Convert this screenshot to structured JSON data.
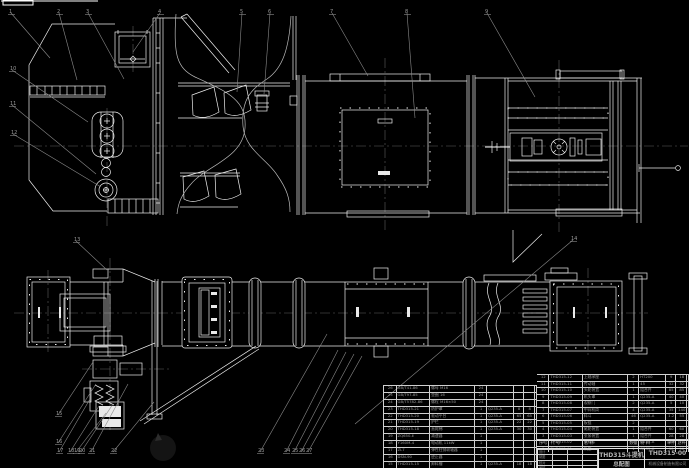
{
  "colors": {
    "background": "#000000",
    "line": "#ededed",
    "leader": "#8a8a8a",
    "bom_text": "#9a9a9a"
  },
  "title_block": {
    "product": "THD315斗提机",
    "sheet": "总配图",
    "drawing_no": "THD315-00",
    "company": "机械设备制造有限公司",
    "sign_labels": [
      "设计",
      "制图",
      "校对",
      "审核"
    ]
  },
  "bom": {
    "headers": {
      "seq": "序号",
      "code": "代  号",
      "name": "名  称",
      "qty": "数量",
      "mat": "材  料",
      "w1": "单件",
      "w2": "总计",
      "note": "备注"
    },
    "left_rows": [
      {
        "seq": "26",
        "code": "GB/T41-86",
        "name": "螺母 M16",
        "qty": "24",
        "mat": "",
        "w1": "",
        "w2": "",
        "note": ""
      },
      {
        "seq": "25",
        "code": "GB/T97-85",
        "name": "垫圈 16",
        "qty": "24",
        "mat": "",
        "w1": "",
        "w2": "",
        "note": ""
      },
      {
        "seq": "24",
        "code": "GB/T5782-86",
        "name": "螺栓 M16×50",
        "qty": "24",
        "mat": "",
        "w1": "",
        "w2": "",
        "note": ""
      },
      {
        "seq": "23",
        "code": "THD315-21",
        "name": "防护罩",
        "qty": "1",
        "mat": "Q235-A",
        "w1": "8",
        "w2": "8",
        "note": ""
      },
      {
        "seq": "22",
        "code": "THD315-20",
        "name": "驱动平台",
        "qty": "1",
        "mat": "Q235-A",
        "w1": "65",
        "w2": "65",
        "note": ""
      },
      {
        "seq": "21",
        "code": "THD315-19",
        "name": "护栏",
        "qty": "1",
        "mat": "Q235-A",
        "w1": "22",
        "w2": "22",
        "note": ""
      },
      {
        "seq": "20",
        "code": "THD315-18",
        "name": "直爬梯",
        "qty": "1",
        "mat": "Q235-A",
        "w1": "30",
        "w2": "30",
        "note": ""
      },
      {
        "seq": "19",
        "code": "ZQ650-Ⅱ",
        "name": "减速器",
        "qty": "1",
        "mat": "",
        "w1": "",
        "w2": "",
        "note": "外购"
      },
      {
        "seq": "18",
        "code": "Y160M-4",
        "name": "电动机 11kW",
        "qty": "1",
        "mat": "",
        "w1": "",
        "w2": "",
        "note": "外购"
      },
      {
        "seq": "17",
        "code": "ZL7",
        "name": "弹性柱销联轴器",
        "qty": "1",
        "mat": "",
        "w1": "",
        "w2": "",
        "note": "外购"
      },
      {
        "seq": "16",
        "code": "DSN-90",
        "name": "逆止器",
        "qty": "1",
        "mat": "",
        "w1": "",
        "w2": "",
        "note": "外购"
      },
      {
        "seq": "15",
        "code": "THD315-15",
        "name": "卸料槽",
        "qty": "1",
        "mat": "Q235-A",
        "w1": "18",
        "w2": "18",
        "note": ""
      },
      {
        "seq": "14",
        "code": "THD315-14",
        "name": "下料斗",
        "qty": "1",
        "mat": "Q235-A",
        "w1": "25",
        "w2": "25",
        "note": ""
      },
      {
        "seq": "13",
        "code": "THD315-13",
        "name": "检修门",
        "qty": "2",
        "mat": "Q235-A",
        "w1": "6",
        "w2": "12",
        "note": ""
      }
    ],
    "right_rows": [
      {
        "seq": "12",
        "code": "THD315-12",
        "name": "上轴承座",
        "qty": "2",
        "mat": "HT200",
        "w1": "9",
        "w2": "18",
        "note": ""
      },
      {
        "seq": "11",
        "code": "THD315-11",
        "name": "传动轴",
        "qty": "1",
        "mat": "45",
        "w1": "32",
        "w2": "32",
        "note": ""
      },
      {
        "seq": "10",
        "code": "THD315-10",
        "name": "头轮装置",
        "qty": "1",
        "mat": "组合件",
        "w1": "85",
        "w2": "85",
        "note": ""
      },
      {
        "seq": "9",
        "code": "THD315-09",
        "name": "机头罩",
        "qty": "1",
        "mat": "Q235-A",
        "w1": "40",
        "w2": "40",
        "note": ""
      },
      {
        "seq": "8",
        "code": "THD315-08",
        "name": "观察门",
        "qty": "2",
        "mat": "Q235-A",
        "w1": "5",
        "w2": "10",
        "note": ""
      },
      {
        "seq": "7",
        "code": "THD315-07",
        "name": "中间机筒",
        "qty": "4",
        "mat": "Q235-A",
        "w1": "35",
        "w2": "140",
        "note": ""
      },
      {
        "seq": "6",
        "code": "THD315-06",
        "name": "料斗",
        "qty": "46",
        "mat": "Q235-A",
        "w1": "1.2",
        "w2": "55",
        "note": ""
      },
      {
        "seq": "5",
        "code": "THD315-05",
        "name": "板链",
        "qty": "2",
        "mat": "",
        "w1": "",
        "w2": "",
        "note": "外购"
      },
      {
        "seq": "4",
        "code": "THD315-04",
        "name": "尾轮装置",
        "qty": "1",
        "mat": "组合件",
        "w1": "60",
        "w2": "60",
        "note": ""
      },
      {
        "seq": "3",
        "code": "THD315-03",
        "name": "张紧装置",
        "qty": "1",
        "mat": "组合件",
        "w1": "28",
        "w2": "28",
        "note": ""
      },
      {
        "seq": "2",
        "code": "THD315-02",
        "name": "进料斗",
        "qty": "1",
        "mat": "Q235-A",
        "w1": "20",
        "w2": "20",
        "note": ""
      },
      {
        "seq": "1",
        "code": "THD315-01",
        "name": "机座",
        "qty": "1",
        "mat": "Q235-A",
        "w1": "90",
        "w2": "90",
        "note": ""
      }
    ]
  },
  "callouts": [
    {
      "n": "1",
      "x": 9,
      "y": 9,
      "tx": 50,
      "ty": 58
    },
    {
      "n": "2",
      "x": 57,
      "y": 9,
      "tx": 77,
      "ty": 80
    },
    {
      "n": "3",
      "x": 86,
      "y": 9,
      "tx": 124,
      "ty": 79
    },
    {
      "n": "4",
      "x": 158,
      "y": 9,
      "tx": 133,
      "ty": 52
    },
    {
      "n": "5",
      "x": 240,
      "y": 9,
      "tx": 237,
      "ty": 92
    },
    {
      "n": "6",
      "x": 268,
      "y": 9,
      "tx": 264,
      "ty": 94
    },
    {
      "n": "7",
      "x": 330,
      "y": 9,
      "tx": 368,
      "ty": 76
    },
    {
      "n": "8",
      "x": 405,
      "y": 9,
      "tx": 415,
      "ty": 118
    },
    {
      "n": "9",
      "x": 485,
      "y": 9,
      "tx": 535,
      "ty": 97
    },
    {
      "n": "10",
      "x": 10,
      "y": 66,
      "tx": 88,
      "ty": 122
    },
    {
      "n": "11",
      "x": 10,
      "y": 101,
      "tx": 96,
      "ty": 174
    },
    {
      "n": "12",
      "x": 11,
      "y": 130,
      "tx": 101,
      "ty": 187
    },
    {
      "n": "13",
      "x": 74,
      "y": 237,
      "tx": 107,
      "ty": 270
    },
    {
      "n": "14",
      "x": 571,
      "y": 236,
      "tx": 355,
      "ty": 424
    },
    {
      "n": "15",
      "x": 56,
      "y": 411,
      "tx": 93,
      "ty": 362
    },
    {
      "n": "16",
      "x": 56,
      "y": 439,
      "tx": 96,
      "ty": 384
    },
    {
      "n": "17",
      "x": 57,
      "y": 448,
      "tx": 90,
      "ty": 399
    },
    {
      "n": "18",
      "x": 68,
      "y": 448,
      "tx": 99,
      "ty": 406
    },
    {
      "n": "19",
      "x": 74,
      "y": 448,
      "tx": 106,
      "ty": 413
    },
    {
      "n": "20",
      "x": 79,
      "y": 448,
      "tx": 113,
      "ty": 404
    },
    {
      "n": "21",
      "x": 89,
      "y": 448,
      "tx": 128,
      "ty": 384
    },
    {
      "n": "22",
      "x": 111,
      "y": 448,
      "tx": 154,
      "ty": 402
    },
    {
      "n": "23",
      "x": 258,
      "y": 448,
      "tx": 327,
      "ty": 334
    },
    {
      "n": "24",
      "x": 284,
      "y": 448,
      "tx": 338,
      "ty": 350
    },
    {
      "n": "25",
      "x": 292,
      "y": 448,
      "tx": 346,
      "ty": 352
    },
    {
      "n": "26",
      "x": 299,
      "y": 448,
      "tx": 354,
      "ty": 354
    },
    {
      "n": "27",
      "x": 306,
      "y": 448,
      "tx": 362,
      "ty": 356
    }
  ]
}
